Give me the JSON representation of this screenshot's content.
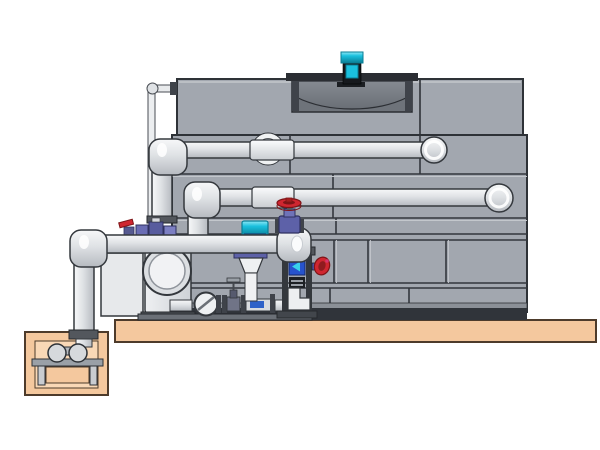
{
  "illustration": {
    "type": "cooling-tower-piping-system",
    "components": [
      "concrete-slab",
      "sump-pit",
      "sump-pump",
      "sump-riser-pipe",
      "cooling-tower-body",
      "cooling-tower-top-section",
      "fan-cowl",
      "fan-motor",
      "makeup-water-line",
      "upper-supply-pipe",
      "middle-return-pipe",
      "discharge-manifold",
      "circulation-pump",
      "suction-inlet",
      "check-valve",
      "gate-valve",
      "ball-valve-cluster",
      "dosing-actuator",
      "injection-cone",
      "control-frame",
      "flow-indicator",
      "globe-valve-red-handwheel",
      "side-handwheel-valve",
      "pipe-wall-ring"
    ]
  },
  "colors": {
    "bg": "#ffffff",
    "slab": "#f4c89e",
    "slabStroke": "#4d3b2b",
    "towerFill": "#a2a7af",
    "towerStroke": "#2e3237",
    "seam": "#33373d",
    "seamLight": "#c3c7cc",
    "basinLedge": "#8b9097",
    "basinDark": "#30343a",
    "recess": "#6e737a",
    "bowlTop": "#868b92",
    "bowlBottom": "#6a6f76",
    "rim": "#2b2e33",
    "rimSide": "#3f434a",
    "pipeLight": "#f7f8f9",
    "pipeMid": "#dfe2e5",
    "pipeDark": "#b6bac0",
    "pipeStroke": "#34383d",
    "sleeveLight": "#fbfcfd",
    "sleeveDark": "#c9cdd1",
    "pumpLight": "#eef0f2",
    "pumpDark": "#ced2d6",
    "panelWhite": "#e7e9eb",
    "cyan": "#1ac0de",
    "cyanDark": "#0a7e95",
    "cyanLight": "#8fe8f6",
    "red": "#cf2630",
    "redDark": "#7e1417",
    "purple": "#5d61a8",
    "purpleDark": "#2f3160",
    "blue": "#2753cc",
    "blueDark": "#12276b",
    "metal": "#53575d",
    "metalDark": "#26292d",
    "frameDark": "#34383d",
    "magenta": "#d6336c"
  }
}
